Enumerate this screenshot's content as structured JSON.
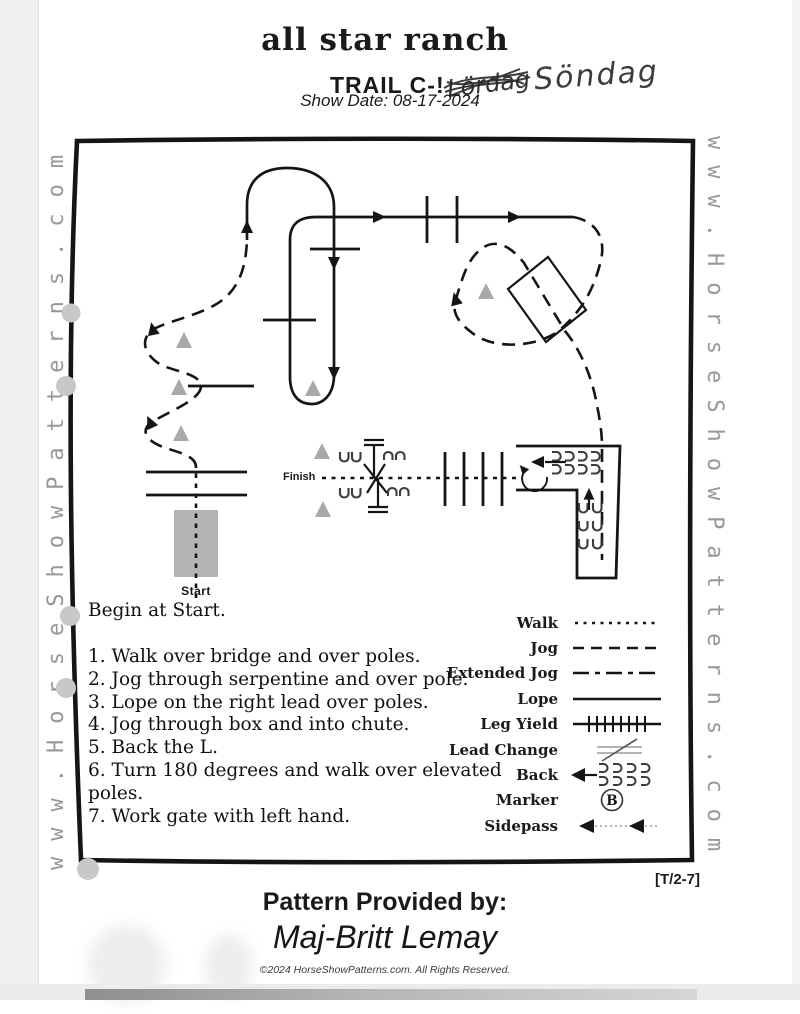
{
  "header": {
    "title": "all star ranch",
    "subtitle": "TRAIL C-!",
    "crossed_out_word": "Lördag",
    "handwritten_word": "Söndag",
    "show_date": "Show Date: 08-17-2024"
  },
  "watermark": {
    "text": "www.HorseShowPatterns.com"
  },
  "course": {
    "start_label": "Start",
    "finish_label": "Finish"
  },
  "instructions": {
    "intro": "Begin at Start.",
    "steps": [
      "1. Walk over bridge and over poles.",
      "2. Jog through serpentine and over pole.",
      "3. Lope on the right lead over poles.",
      "4. Jog through box and into chute.",
      "5. Back the L.",
      "6. Turn 180 degrees and walk over elevated poles.",
      "7. Work gate with left hand."
    ]
  },
  "legend": {
    "items": [
      {
        "label": "Walk",
        "symbol": "dotted-line"
      },
      {
        "label": "Jog",
        "symbol": "dashed-line"
      },
      {
        "label": "Extended Jog",
        "symbol": "dash-dot-line"
      },
      {
        "label": "Lope",
        "symbol": "solid-line"
      },
      {
        "label": "Leg Yield",
        "symbol": "hatched-line"
      },
      {
        "label": "Lead Change",
        "symbol": "slash-over-lines"
      },
      {
        "label": "Back",
        "symbol": "hoofprints-left-arrow"
      },
      {
        "label": "Marker",
        "symbol": "circled-letter",
        "marker_letter": "B"
      },
      {
        "label": "Sidepass",
        "symbol": "double-left-arrow"
      }
    ]
  },
  "footer": {
    "pattern_code": "[T/2-7]",
    "provided_by_label": "Pattern Provided by:",
    "provided_by_name": "Maj-Britt Lemay",
    "copyright": "©2024 HorseShowPatterns.com. All Rights Reserved."
  },
  "colors": {
    "ink": "#151515",
    "watermark_gray": "#989898",
    "cone_gray": "#a9a9a9",
    "bridge_gray": "#b4b4b2"
  }
}
